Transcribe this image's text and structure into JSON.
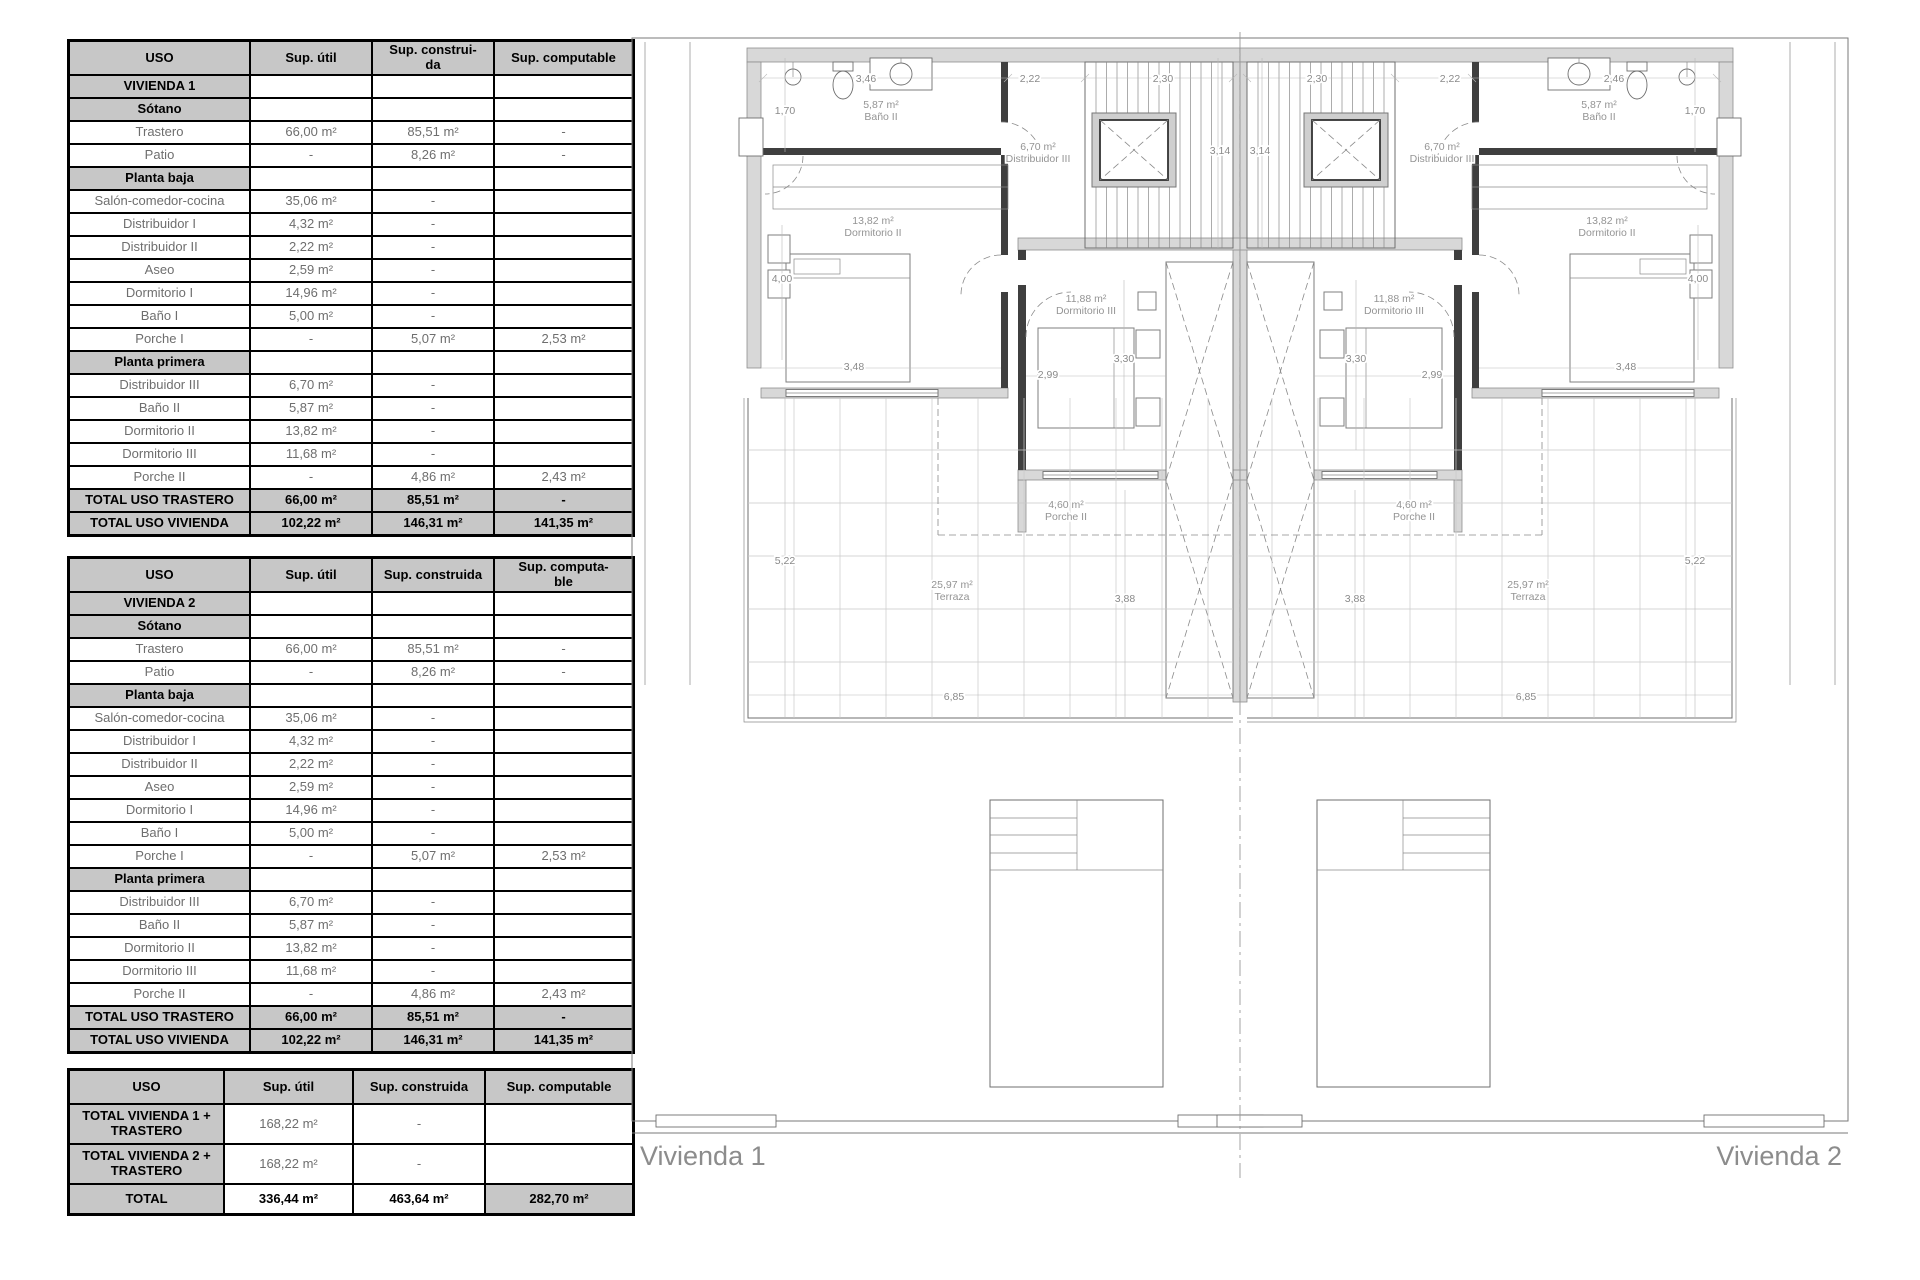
{
  "colors": {
    "table_header_bg": "#c7c7c7",
    "table_border": "#000000",
    "data_text": "#6e6e6e",
    "wall_fill": "#d8d8d8",
    "plan_line": "#6f6f6f",
    "plan_label": "#949494"
  },
  "tables": [
    {
      "id": "vivienda-1",
      "header": [
        "USO",
        "Sup. útil",
        "Sup. construi-\nda",
        "Sup. computable"
      ],
      "rows": [
        {
          "type": "section",
          "cells": [
            "VIVIENDA 1",
            "",
            "",
            ""
          ]
        },
        {
          "type": "section",
          "cells": [
            "Sótano",
            "",
            "",
            ""
          ]
        },
        {
          "type": "data",
          "cells": [
            "Trastero",
            "66,00 m²",
            "85,51 m²",
            "-"
          ]
        },
        {
          "type": "data",
          "cells": [
            "Patio",
            "-",
            "8,26 m²",
            "-"
          ]
        },
        {
          "type": "section",
          "cells": [
            "Planta baja",
            "",
            "",
            ""
          ]
        },
        {
          "type": "data",
          "cells": [
            "Salón-comedor-cocina",
            "35,06 m²",
            "-",
            ""
          ]
        },
        {
          "type": "data",
          "cells": [
            "Distribuidor I",
            "4,32 m²",
            "-",
            ""
          ]
        },
        {
          "type": "data",
          "cells": [
            "Distribuidor II",
            "2,22 m²",
            "-",
            ""
          ]
        },
        {
          "type": "data",
          "cells": [
            "Aseo",
            "2,59 m²",
            "-",
            ""
          ]
        },
        {
          "type": "data",
          "cells": [
            "Dormitorio I",
            "14,96 m²",
            "-",
            ""
          ]
        },
        {
          "type": "data",
          "cells": [
            "Baño I",
            "5,00 m²",
            "-",
            ""
          ]
        },
        {
          "type": "data",
          "cells": [
            "Porche I",
            "-",
            "5,07 m²",
            "2,53 m²"
          ]
        },
        {
          "type": "section",
          "cells": [
            "Planta primera",
            "",
            "",
            ""
          ]
        },
        {
          "type": "data",
          "cells": [
            "Distribuidor III",
            "6,70 m²",
            "-",
            ""
          ]
        },
        {
          "type": "data",
          "cells": [
            "Baño II",
            "5,87 m²",
            "-",
            ""
          ]
        },
        {
          "type": "data",
          "cells": [
            "Dormitorio II",
            "13,82 m²",
            "-",
            ""
          ]
        },
        {
          "type": "data",
          "cells": [
            "Dormitorio III",
            "11,68 m²",
            "-",
            ""
          ]
        },
        {
          "type": "data",
          "cells": [
            "Porche II",
            "-",
            "4,86 m²",
            "2,43 m²"
          ]
        },
        {
          "type": "total",
          "cells": [
            "TOTAL USO TRASTERO",
            "66,00 m²",
            "85,51 m²",
            "-"
          ]
        },
        {
          "type": "total",
          "cells": [
            "TOTAL USO VIVIENDA",
            "102,22 m²",
            "146,31 m²",
            "141,35 m²"
          ]
        }
      ]
    },
    {
      "id": "vivienda-2",
      "header": [
        "USO",
        "Sup. útil",
        "Sup. construida",
        "Sup. computa-\nble"
      ],
      "rows": [
        {
          "type": "section",
          "cells": [
            "VIVIENDA 2",
            "",
            "",
            ""
          ]
        },
        {
          "type": "section",
          "cells": [
            "Sótano",
            "",
            "",
            ""
          ]
        },
        {
          "type": "data",
          "cells": [
            "Trastero",
            "66,00 m²",
            "85,51 m²",
            "-"
          ]
        },
        {
          "type": "data",
          "cells": [
            "Patio",
            "-",
            "8,26 m²",
            "-"
          ]
        },
        {
          "type": "section",
          "cells": [
            "Planta baja",
            "",
            "",
            ""
          ]
        },
        {
          "type": "data",
          "cells": [
            "Salón-comedor-cocina",
            "35,06 m²",
            "-",
            ""
          ]
        },
        {
          "type": "data",
          "cells": [
            "Distribuidor I",
            "4,32 m²",
            "-",
            ""
          ]
        },
        {
          "type": "data",
          "cells": [
            "Distribuidor II",
            "2,22 m²",
            "-",
            ""
          ]
        },
        {
          "type": "data",
          "cells": [
            "Aseo",
            "2,59 m²",
            "-",
            ""
          ]
        },
        {
          "type": "data",
          "cells": [
            "Dormitorio I",
            "14,96 m²",
            "-",
            ""
          ]
        },
        {
          "type": "data",
          "cells": [
            "Baño I",
            "5,00 m²",
            "-",
            ""
          ]
        },
        {
          "type": "data",
          "cells": [
            "Porche I",
            "-",
            "5,07 m²",
            "2,53 m²"
          ]
        },
        {
          "type": "section",
          "cells": [
            "Planta primera",
            "",
            "",
            ""
          ]
        },
        {
          "type": "data",
          "cells": [
            "Distribuidor III",
            "6,70 m²",
            "-",
            ""
          ]
        },
        {
          "type": "data",
          "cells": [
            "Baño II",
            "5,87 m²",
            "-",
            ""
          ]
        },
        {
          "type": "data",
          "cells": [
            "Dormitorio II",
            "13,82 m²",
            "-",
            ""
          ]
        },
        {
          "type": "data",
          "cells": [
            "Dormitorio III",
            "11,68 m²",
            "-",
            ""
          ]
        },
        {
          "type": "data",
          "cells": [
            "Porche II",
            "-",
            "4,86 m²",
            "2,43 m²"
          ]
        },
        {
          "type": "total",
          "cells": [
            "TOTAL USO TRASTERO",
            "66,00 m²",
            "85,51 m²",
            "-"
          ]
        },
        {
          "type": "total",
          "cells": [
            "TOTAL USO VIVIENDA",
            "102,22 m²",
            "146,31 m²",
            "141,35 m²"
          ]
        }
      ]
    },
    {
      "id": "totales",
      "header": [
        "USO",
        "Sup. útil",
        "Sup. construida",
        "Sup. computable"
      ],
      "rows": [
        {
          "type": "databold",
          "cells": [
            "TOTAL VIVIENDA 1 +\nTRASTERO",
            "168,22 m²",
            "-",
            ""
          ]
        },
        {
          "type": "databold",
          "cells": [
            "TOTAL VIVIENDA 2 +\nTRASTERO",
            "168,22 m²",
            "-",
            ""
          ]
        },
        {
          "type": "grand",
          "cells": [
            "TOTAL",
            "336,44 m²",
            "463,64  m²",
            "282,70  m²"
          ]
        }
      ]
    }
  ],
  "floorplan": {
    "unit_labels": [
      {
        "text": "Vivienda 1",
        "x": 22,
        "y": 1135,
        "anchor": "start"
      },
      {
        "text": "Vivienda 2",
        "x": 1224,
        "y": 1135,
        "anchor": "end"
      }
    ],
    "room_labels": [
      {
        "area": "5,87 m²",
        "name": "Baño II",
        "x": 263,
        "y": 78
      },
      {
        "area": "6,70 m²",
        "name": "Distribuidor III",
        "x": 420,
        "y": 120
      },
      {
        "area": "13,82 m²",
        "name": "Dormitorio II",
        "x": 255,
        "y": 194
      },
      {
        "area": "11,88 m²",
        "name": "Dormitorio III",
        "x": 468,
        "y": 272
      },
      {
        "area": "4,60 m²",
        "name": "Porche II",
        "x": 448,
        "y": 478
      },
      {
        "area": "25,97 m²",
        "name": "Terraza",
        "x": 334,
        "y": 558
      },
      {
        "area": "5,87 m²",
        "name": "Baño II",
        "x": 981,
        "y": 78
      },
      {
        "area": "6,70 m²",
        "name": "Distribuidor III",
        "x": 824,
        "y": 120
      },
      {
        "area": "13,82 m²",
        "name": "Dormitorio II",
        "x": 989,
        "y": 194
      },
      {
        "area": "11,88 m²",
        "name": "Dormitorio III",
        "x": 776,
        "y": 272
      },
      {
        "area": "4,60 m²",
        "name": "Porche II",
        "x": 796,
        "y": 478
      },
      {
        "area": "25,97 m²",
        "name": "Terraza",
        "x": 910,
        "y": 558
      }
    ],
    "dim_labels": [
      {
        "text": "3,46",
        "x": 248,
        "y": 52
      },
      {
        "text": "2,22",
        "x": 412,
        "y": 52
      },
      {
        "text": "2,30",
        "x": 545,
        "y": 52
      },
      {
        "text": "1,70",
        "x": 167,
        "y": 84
      },
      {
        "text": "4,00",
        "x": 164,
        "y": 252
      },
      {
        "text": "3,48",
        "x": 236,
        "y": 340
      },
      {
        "text": "2,99",
        "x": 430,
        "y": 348
      },
      {
        "text": "3,30",
        "x": 506,
        "y": 332
      },
      {
        "text": "5,22",
        "x": 167,
        "y": 534
      },
      {
        "text": "3,88",
        "x": 507,
        "y": 572
      },
      {
        "text": "6,85",
        "x": 336,
        "y": 670
      },
      {
        "text": "3,14",
        "x": 602,
        "y": 124
      },
      {
        "text": "2,46",
        "x": 996,
        "y": 52
      },
      {
        "text": "2,22",
        "x": 832,
        "y": 52
      },
      {
        "text": "2,30",
        "x": 699,
        "y": 52
      },
      {
        "text": "1,70",
        "x": 1077,
        "y": 84
      },
      {
        "text": "4,00",
        "x": 1080,
        "y": 252
      },
      {
        "text": "3,48",
        "x": 1008,
        "y": 340
      },
      {
        "text": "2,99",
        "x": 814,
        "y": 348
      },
      {
        "text": "3,30",
        "x": 738,
        "y": 332
      },
      {
        "text": "5,22",
        "x": 1077,
        "y": 534
      },
      {
        "text": "3,88",
        "x": 737,
        "y": 572
      },
      {
        "text": "6,85",
        "x": 908,
        "y": 670
      },
      {
        "text": "3,14",
        "x": 642,
        "y": 124
      }
    ]
  }
}
